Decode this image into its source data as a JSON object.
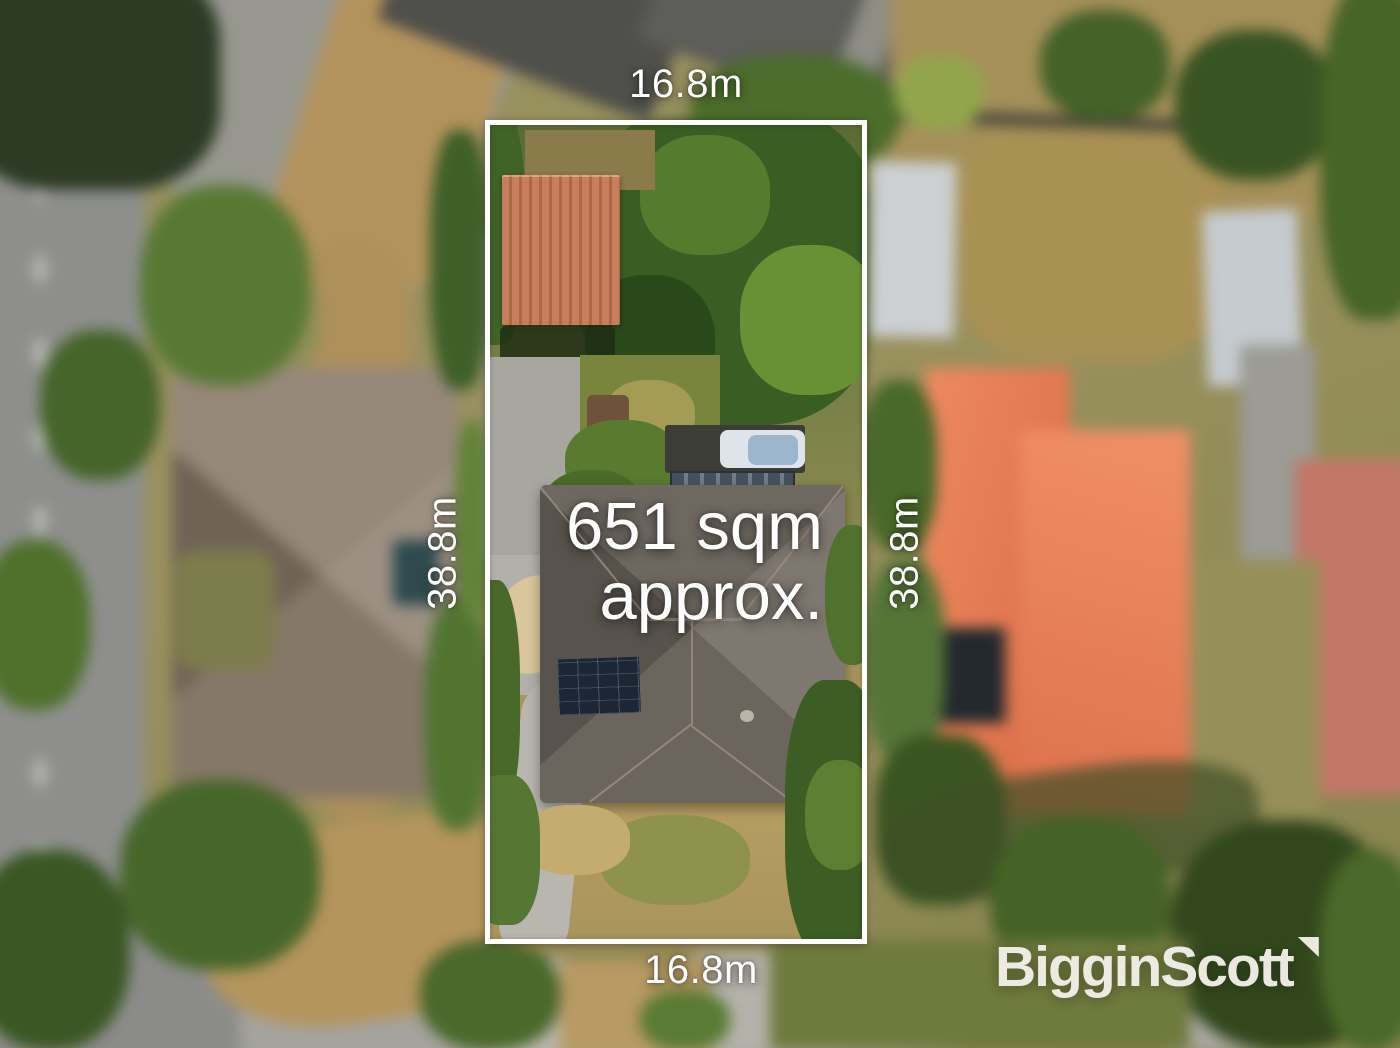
{
  "overlay": {
    "boundary_color": "#ffffff",
    "text_color": "#ffffff",
    "dimensions": {
      "top": "16.8m",
      "bottom": "16.8m",
      "left": "38.8m",
      "right": "38.8m"
    },
    "area_label": {
      "line1": "651 sqm",
      "line2": "approx."
    }
  },
  "branding": {
    "logo_text": "BigginScott",
    "logo_color": "#f1eee7"
  },
  "scene": {
    "inside_lot_colors": {
      "shed_roof": "#c07a5a",
      "driveway": "#a8a8a2",
      "house_roof": "#6b655f",
      "solar_panels": "#1e2835",
      "dry_lawn": "#b29a62",
      "trees": "#3f5f28"
    },
    "surroundings_colors": {
      "left_house_roof": "#8b7e73",
      "right_house_roof": "#e08059",
      "far_right_house_roof": "#c07868",
      "roads": "#8e8f8d",
      "dry_grass": "#ad905d"
    }
  }
}
